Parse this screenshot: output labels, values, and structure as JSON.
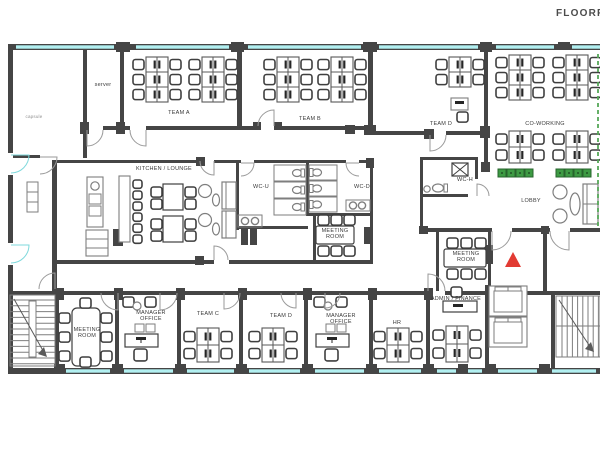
{
  "title": "FLOORPLAN",
  "colors": {
    "wall": "#454545",
    "line": "#7e7e7e",
    "line_dark": "#3f3f3f",
    "dark": "#262626",
    "window": "#b2f0f1",
    "glass_door": "#7fd9dc",
    "plant": "#3d9a43",
    "plant_dark": "#27642c",
    "entrance_arrow": "#e23b33",
    "section_line": "#55a858",
    "stair_arrow": "#5a5a5a"
  },
  "rooms": {
    "capsule": {
      "label": "capsule"
    },
    "server": {
      "label": "server"
    },
    "team_a": {
      "label": "TEAM A"
    },
    "team_b": {
      "label": "TEAM B"
    },
    "team_d_top": {
      "label": "TEAM D"
    },
    "coworking": {
      "label": "CO-WORKING"
    },
    "kitchen_lounge": {
      "label": "KITCHEN / LOUNGE"
    },
    "wc_u": {
      "label": "WC-U"
    },
    "wc_d": {
      "label": "WC-D"
    },
    "wc_h": {
      "label": "WC-H"
    },
    "lobby": {
      "label": "LOBBY"
    },
    "meeting_center": {
      "label": "MEETING ROOM"
    },
    "meeting_right": {
      "label": "MEETING ROOM"
    },
    "meeting_bottom_left": {
      "label": "MEETING ROOM"
    },
    "manager_office_left": {
      "label": "MANAGER OFFICE"
    },
    "team_c": {
      "label": "TEAM C"
    },
    "team_d_bottom": {
      "label": "TEAM D"
    },
    "manager_office_mid": {
      "label": "MANAGER OFFICE"
    },
    "hr": {
      "label": "HR"
    },
    "admin_finance": {
      "label": "ADMIN / FINANCE"
    }
  }
}
